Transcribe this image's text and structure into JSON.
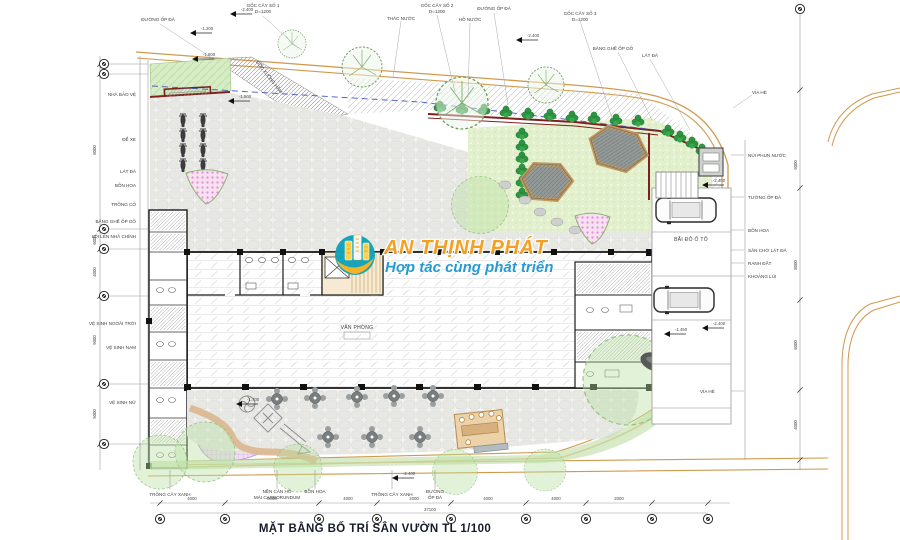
{
  "title": {
    "text": "MẶT BẰNG BỐ TRÍ SÂN VƯỜN TL 1/100",
    "scale": "1/100"
  },
  "watermark": {
    "brand": "AN THỊNH PHÁT",
    "tagline": "Hợp tác cùng phát triển",
    "brand_color": "#f59e1c",
    "tagline_color": "#1f97cf",
    "logo_teal": "#11a3ba",
    "logo_yellow": "#f4b223"
  },
  "labels": {
    "top": [
      "ĐƯỜNG ỐP ĐÁ",
      "GỐC CÂY SỐ 1",
      "D=1200",
      "THÁC NƯỚC",
      "GỐC CÂY SỐ 2",
      "D=1200",
      "HỒ NƯỚC",
      "ĐƯỜNG ỐP ĐÁ",
      "GỐC CÂY SỐ 3",
      "D=1200",
      "BĂNG GHẾ ỐP GỖ",
      "LÁT ĐÁ",
      "VỈA HÈ"
    ],
    "left": [
      "NHÀ BẢO VỆ",
      "ĐỂ XE",
      "LÁT ĐÁ",
      "BỒN HOA",
      "TRỒNG CỎ",
      "BĂNG GHẾ ỐP GỖ",
      "LỐI LÊN NHÀ CHÍNH",
      "VỆ SINH NGOÀI TRỜI",
      "VỆ SINH NAM",
      "VỆ SINH NỮ"
    ],
    "right": [
      "NÚI PHUN NƯỚC",
      "TƯỜNG ỐP ĐÁ",
      "BỒN HOA",
      "SÂN CHỜ LÁT ĐÁ",
      "RANH ĐẤT",
      "KHOẢNG LÙI",
      "VỈA HÈ"
    ],
    "bottom": [
      "TRỒNG CÂY XANH",
      "NỀN CÁN HỒ",
      "MÀI CARBORUNDUM",
      "BỒN HOA",
      "TRỒNG CÂY XANH",
      "ĐƯỜNG",
      "ỐP ĐÁ"
    ],
    "interior": [
      "VĂN PHÒNG",
      "BÃI ĐỖ Ô TÔ",
      "DỐC XUỐNG HẦM"
    ]
  },
  "elev": [
    "-2.400",
    "-1.200",
    "-1.800",
    "-1.500",
    "-2.400",
    "-2.400",
    "-2.400",
    "-2.400",
    "-1.700",
    "-1.450"
  ],
  "dims": {
    "bottom": [
      "4000",
      "8000",
      "4000",
      "2000",
      "4000",
      "4000",
      "2000"
    ],
    "bottom_total": "37100",
    "left": [
      "8000",
      "6000",
      "4000",
      "9000",
      "5000"
    ],
    "right": [
      "9000",
      "8000",
      "6000",
      "4000"
    ]
  },
  "colors": {
    "boundary_orange": "#cf9a4e",
    "wall_maroon": "#7d2020",
    "lawn_green": "#d6ecc4",
    "hedge_green": "#2e9440",
    "setback_blue": "#3a4fc0",
    "rock_grey": "#949b98",
    "flower_pink": "#e08cd8"
  }
}
